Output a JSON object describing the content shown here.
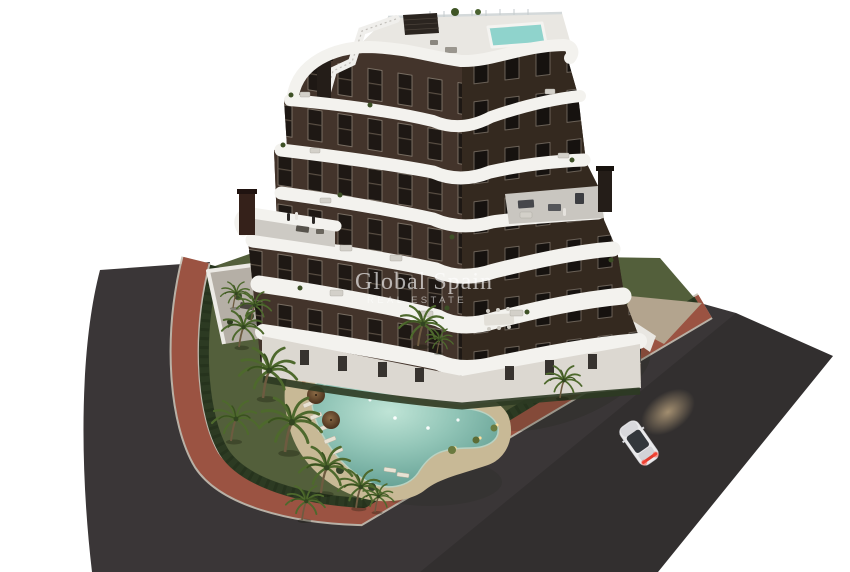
{
  "watermark": {
    "title": "Global Spain",
    "subtitle": "REAL ESTATE"
  },
  "colors": {
    "background": "#ffffff",
    "asphalt": "#3a3637",
    "sidewalk": "#9b5342",
    "curb": "#c6bfb2",
    "lawn": "#535f3b",
    "hedge": "#2c3a22",
    "sand": "#c8b996",
    "pool_edge": "#5f9c90",
    "pool_center": "#b7e0d2",
    "facade_left": "#43342b",
    "facade_right": "#34291f",
    "band": "#f3f2ee",
    "roof": "#e9e7e2",
    "rooftop_pool": "#8fd3cc",
    "pergola": "#2b2520",
    "base_wall": "#dcd8d1",
    "terrace_floor": "#cdcac4",
    "courtyard": "#b5afa6",
    "island_bed": "#3c4a2b",
    "palm_frond": "#4e692d",
    "palm_trunk": "#6d5b40",
    "car_body": "#e9e9eb",
    "taillight": "#e03b2e",
    "headlight_glow": "#ffd9a0",
    "umbrella": "#6e4c33",
    "lounger": "#e8e2d4"
  }
}
